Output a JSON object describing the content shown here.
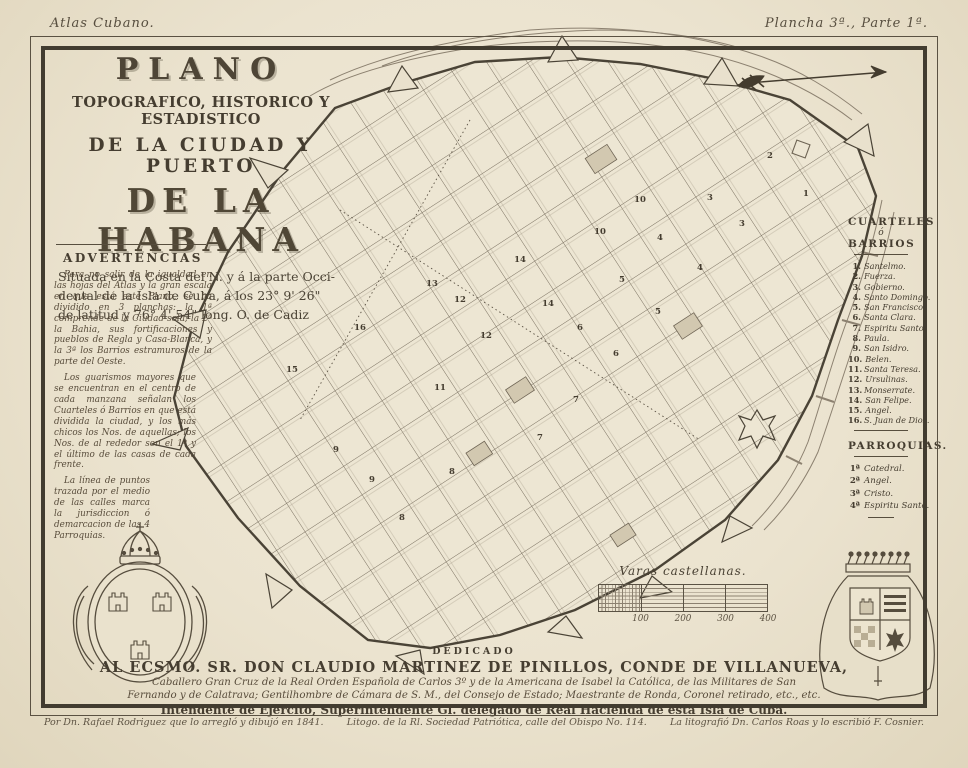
{
  "page": {
    "atlas_label": "Atlas Cubano.",
    "plate_label": "Plancha 3ª., Parte 1ª.",
    "credit_left": "Por Dn. Rafael Rodriguez que lo arregló y dibujó en 1841.",
    "credit_center": "Litogo. de la Rl. Sociedad Patriótica, calle del Obispo No. 114.",
    "credit_right": "La litografió Dn. Carlos Roas y lo escribió F. Cosnier."
  },
  "title_block": {
    "kicker": "PLANO",
    "line2": "TOPOGRAFICO, HISTORICO Y ESTADISTICO",
    "line3": "DE LA CIUDAD Y PUERTO",
    "line4": "DE LA HABANA",
    "subtitle_lines": [
      "Situada en la Costa del N. y á la parte Occi-",
      "dental de la Isla de Cuba, á los 23° 9' 26\"",
      "de latitud y 76° 4' 54\" long. O. de Cadiz"
    ]
  },
  "advertencias": {
    "heading": "ADVERTENCIAS",
    "paragraphs": [
      "Para no salir de la igualdad en las hojas del Atlas y la gran escala en que está este Plano, se ha dividido en 3 planchas: la 1ª comprende de la Ciudad sola; la 2ª la Bahia, sus fortificaciones y pueblos de Regla y Casa-Blanca, y la 3ª los Barrios estramuros de la parte del Oeste.",
      "Los guarismos mayores que se encuentran en el centro de cada manzana señalan los Cuarteles ó Barrios en que está dividida la ciudad, y los más chicos los Nos. de aquellas; los Nos. de al rededor son el 1º y el último de las casas de cada frente.",
      "La línea de puntos trazada por el medio de las calles marca la jurisdiccion ó demarcacion de las 4 Parroquias."
    ]
  },
  "legend": {
    "cuarteles_title_top": "CUARTELES",
    "cuarteles_amp": "ó",
    "cuarteles_title_bottom": "BARRIOS",
    "cuarteles": [
      {
        "n": "1.",
        "label": "Santelmo."
      },
      {
        "n": "2.",
        "label": "Fuerza."
      },
      {
        "n": "3.",
        "label": "Gobierno."
      },
      {
        "n": "4.",
        "label": "Santo Domingo."
      },
      {
        "n": "5.",
        "label": "San Francisco."
      },
      {
        "n": "6.",
        "label": "Santa Clara."
      },
      {
        "n": "7.",
        "label": "Espiritu Santo."
      },
      {
        "n": "8.",
        "label": "Paula."
      },
      {
        "n": "9.",
        "label": "San Isidro."
      },
      {
        "n": "10.",
        "label": "Belen."
      },
      {
        "n": "11.",
        "label": "Santa Teresa."
      },
      {
        "n": "12.",
        "label": "Ursulinas."
      },
      {
        "n": "13.",
        "label": "Monserrate."
      },
      {
        "n": "14.",
        "label": "San Felipe."
      },
      {
        "n": "15.",
        "label": "Angel."
      },
      {
        "n": "16.",
        "label": "S. Juan de Dios."
      }
    ],
    "parroquias_title": "PARROQUIAS.",
    "parroquias": [
      {
        "n": "1ª",
        "label": "Catedral."
      },
      {
        "n": "2ª",
        "label": "Angel."
      },
      {
        "n": "3ª",
        "label": "Cristo."
      },
      {
        "n": "4ª",
        "label": "Espiritu Santo."
      }
    ]
  },
  "scalebar": {
    "label": "Varas castellanas.",
    "ticks": [
      "100",
      "200",
      "300",
      "400"
    ]
  },
  "dedication": {
    "kicker": "DEDICADO",
    "line1": "AL ECSMO. SR. DON CLAUDIO MARTINEZ DE PINILLOS, CONDE DE VILLANUEVA,",
    "line2": "Caballero Gran Cruz de la Real Orden Española de Carlos 3º y de la Americana de Isabel la Católica, de las Militares de San",
    "line3": "Fernando y de Calatrava; Gentilhombre de Cámara de S. M., del Consejo de Estado; Maestrante de Ronda, Coronel retirado, etc., etc.",
    "line4": "Intendente de Ejercito, Superintendente Gl. delegado de Real Hacienda de esta Isla de Cuba."
  },
  "map": {
    "cuartel_markers": [
      {
        "n": "1",
        "x": 806,
        "y": 196
      },
      {
        "n": "2",
        "x": 770,
        "y": 158
      },
      {
        "n": "3",
        "x": 742,
        "y": 226
      },
      {
        "n": "3",
        "x": 710,
        "y": 200
      },
      {
        "n": "4",
        "x": 700,
        "y": 270
      },
      {
        "n": "4",
        "x": 660,
        "y": 240
      },
      {
        "n": "5",
        "x": 658,
        "y": 314
      },
      {
        "n": "5",
        "x": 622,
        "y": 282
      },
      {
        "n": "6",
        "x": 616,
        "y": 356
      },
      {
        "n": "6",
        "x": 580,
        "y": 330
      },
      {
        "n": "7",
        "x": 576,
        "y": 402
      },
      {
        "n": "7",
        "x": 540,
        "y": 440
      },
      {
        "n": "8",
        "x": 452,
        "y": 474
      },
      {
        "n": "8",
        "x": 402,
        "y": 520
      },
      {
        "n": "9",
        "x": 336,
        "y": 452
      },
      {
        "n": "9",
        "x": 372,
        "y": 482
      },
      {
        "n": "10",
        "x": 600,
        "y": 234
      },
      {
        "n": "10",
        "x": 640,
        "y": 202
      },
      {
        "n": "11",
        "x": 440,
        "y": 390
      },
      {
        "n": "12",
        "x": 486,
        "y": 338
      },
      {
        "n": "12",
        "x": 460,
        "y": 302
      },
      {
        "n": "13",
        "x": 432,
        "y": 286
      },
      {
        "n": "14",
        "x": 548,
        "y": 306
      },
      {
        "n": "14",
        "x": 520,
        "y": 262
      },
      {
        "n": "15",
        "x": 292,
        "y": 372
      },
      {
        "n": "16",
        "x": 360,
        "y": 330
      }
    ]
  }
}
